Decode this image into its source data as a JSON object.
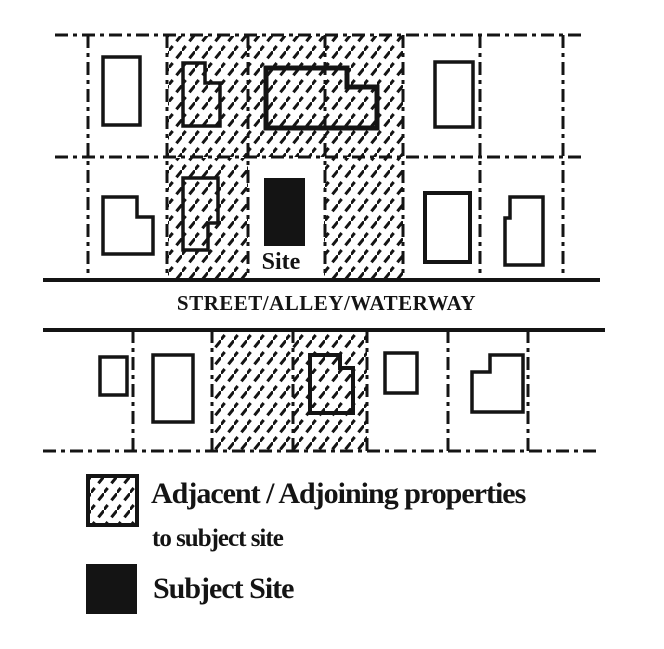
{
  "colors": {
    "ink": "#141414",
    "paper": "#ffffff"
  },
  "labels": {
    "site": "Site",
    "street": "STREET/ALLEY/WATERWAY"
  },
  "legend": {
    "adjacent_line1": "Adjacent / Adjoining properties",
    "adjacent_line2": "to subject site",
    "subject": "Subject Site"
  },
  "diagram": {
    "canvas": {
      "width": 664,
      "height": 649
    },
    "hatched_areas": [
      {
        "name": "adjacent-area-north-toprow",
        "x": 168,
        "y": 36,
        "w": 235,
        "h": 121
      },
      {
        "name": "adjacent-area-north-bottomrow-left",
        "x": 168,
        "y": 158,
        "w": 80,
        "h": 121
      },
      {
        "name": "adjacent-area-north-bottomrow-right",
        "x": 324,
        "y": 158,
        "w": 79,
        "h": 121
      },
      {
        "name": "adjacent-area-south",
        "x": 213,
        "y": 331,
        "w": 154,
        "h": 119
      },
      {
        "name": "legend-adjacent-swatch",
        "x": 88,
        "y": 476,
        "w": 49,
        "h": 49,
        "border": true
      }
    ],
    "boundary_lines": [
      {
        "name": "north-block-top-boundary",
        "style": "dashdot",
        "x1": 55,
        "y1": 35,
        "x2": 585,
        "y2": 35
      },
      {
        "name": "north-block-mid-boundary",
        "style": "dashdot",
        "x1": 55,
        "y1": 157,
        "x2": 585,
        "y2": 157
      },
      {
        "name": "parcel-boundary",
        "style": "dashdot",
        "x1": 88,
        "y1": 35,
        "x2": 88,
        "y2": 280
      },
      {
        "name": "parcel-boundary",
        "style": "dashdot",
        "x1": 167,
        "y1": 35,
        "x2": 167,
        "y2": 280
      },
      {
        "name": "parcel-boundary",
        "style": "dashdot",
        "x1": 248,
        "y1": 35,
        "x2": 248,
        "y2": 280
      },
      {
        "name": "parcel-boundary",
        "style": "dashdot",
        "x1": 325,
        "y1": 35,
        "x2": 325,
        "y2": 280
      },
      {
        "name": "parcel-boundary",
        "style": "dashdot",
        "x1": 403,
        "y1": 35,
        "x2": 403,
        "y2": 280
      },
      {
        "name": "parcel-boundary",
        "style": "dashdot",
        "x1": 480,
        "y1": 35,
        "x2": 480,
        "y2": 280
      },
      {
        "name": "parcel-boundary",
        "style": "dashdot",
        "x1": 563,
        "y1": 35,
        "x2": 563,
        "y2": 280
      },
      {
        "name": "street-north-edge",
        "style": "solid",
        "x1": 43,
        "y1": 280,
        "x2": 600,
        "y2": 280
      },
      {
        "name": "street-south-edge",
        "style": "solid",
        "x1": 43,
        "y1": 330,
        "x2": 605,
        "y2": 330
      },
      {
        "name": "parcel-boundary",
        "style": "dashdot",
        "x1": 133,
        "y1": 330,
        "x2": 133,
        "y2": 451
      },
      {
        "name": "parcel-boundary",
        "style": "dashdot",
        "x1": 212,
        "y1": 330,
        "x2": 212,
        "y2": 451
      },
      {
        "name": "parcel-boundary",
        "style": "dashdot",
        "x1": 293,
        "y1": 330,
        "x2": 293,
        "y2": 451
      },
      {
        "name": "parcel-boundary",
        "style": "dashdot",
        "x1": 367,
        "y1": 330,
        "x2": 367,
        "y2": 451
      },
      {
        "name": "parcel-boundary",
        "style": "dashdot",
        "x1": 448,
        "y1": 330,
        "x2": 448,
        "y2": 451
      },
      {
        "name": "parcel-boundary",
        "style": "dashdot",
        "x1": 528,
        "y1": 330,
        "x2": 528,
        "y2": 451
      },
      {
        "name": "south-block-bottom-boundary",
        "style": "dashdot",
        "x1": 43,
        "y1": 451,
        "x2": 600,
        "y2": 451
      }
    ],
    "buildings": [
      {
        "name": "building-footprint",
        "points": "103,57 140,57 140,125 103,125"
      },
      {
        "name": "building-footprint",
        "points": "183,63 205,63 205,83 220,83 220,126 183,126"
      },
      {
        "name": "building-footprint",
        "points": "266,68 347,68 347,87 377,87 377,128 266,128",
        "sw": 5
      },
      {
        "name": "building-footprint",
        "points": "435,62 473,62 473,127 435,127"
      },
      {
        "name": "building-footprint",
        "points": "103,197 137,197 137,217 153,217 153,254 103,254"
      },
      {
        "name": "building-footprint",
        "points": "183,178 218,178 218,223 208,223 208,250 183,250"
      },
      {
        "name": "subject-site-footprint",
        "points": "264,178 305,178 305,246 264,246",
        "fill": "solid"
      },
      {
        "name": "building-footprint",
        "points": "425,193 470,193 470,262 425,262",
        "sw": 4
      },
      {
        "name": "building-footprint",
        "points": "510,197 543,197 543,265 505,265 505,218 510,218"
      },
      {
        "name": "building-footprint",
        "points": "100,357 127,357 127,395 100,395"
      },
      {
        "name": "building-footprint",
        "points": "153,355 193,355 193,422 153,422"
      },
      {
        "name": "building-footprint",
        "points": "310,355 340,355 340,368 353,368 353,413 310,413",
        "sw": 4
      },
      {
        "name": "building-footprint",
        "points": "385,353 417,353 417,393 385,393"
      },
      {
        "name": "building-footprint",
        "points": "490,355 523,355 523,412 472,412 472,372 490,372"
      },
      {
        "name": "legend-subject-swatch",
        "points": "86,564 137,564 137,614 86,614",
        "fill": "solid"
      }
    ]
  }
}
